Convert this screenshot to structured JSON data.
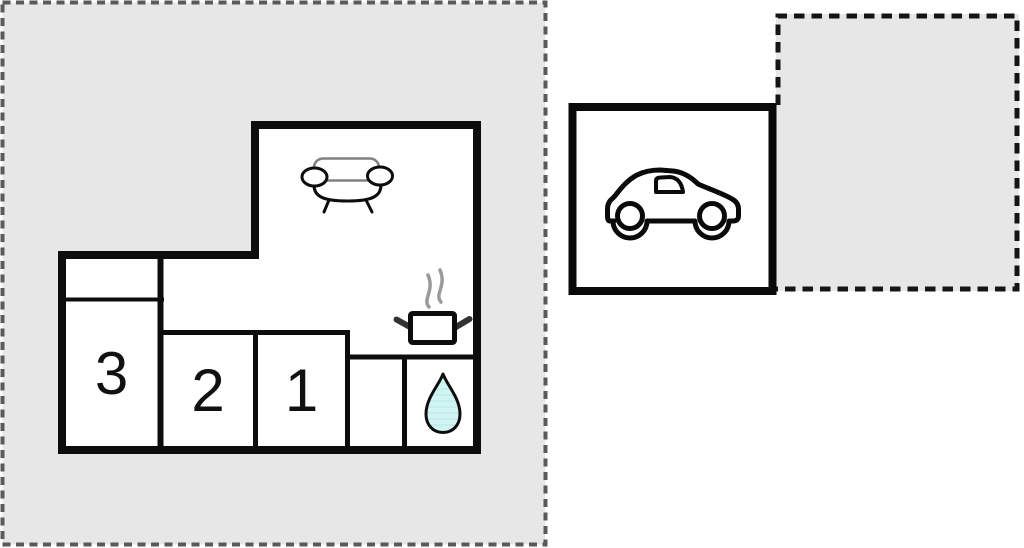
{
  "left_plot": {
    "fill": "#e7e7e7",
    "dash_color": "#5a5a5a"
  },
  "right_plot": {
    "fill": "#e7e7e7",
    "dash_color": "#151515"
  },
  "floor_plan": {
    "wall_color": "#0d0d0d",
    "room_fill": "#ffffff",
    "label_color": "#111111",
    "rooms": [
      {
        "label": "3"
      },
      {
        "label": "2"
      },
      {
        "label": "1"
      }
    ]
  },
  "garage": {
    "border_color": "#0a0a0a",
    "fill": "#ffffff"
  },
  "icons": {
    "sofa": "sofa-icon",
    "cooking_pot": "cooking-pot-icon",
    "steam": "steam-icon",
    "water_drop": "water-drop-icon",
    "car": "car-icon"
  },
  "water_drop": {
    "fill": "#d2f4f2",
    "stripe": "#c3eeec",
    "outline": "#0d0d0d"
  }
}
